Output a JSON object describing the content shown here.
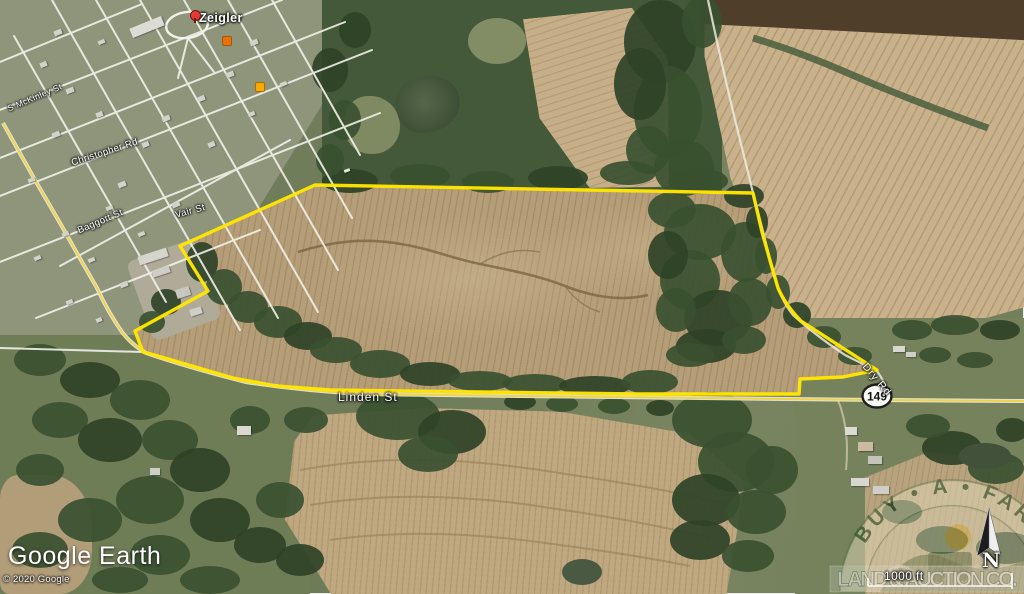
{
  "map": {
    "town_label": "Zeigler",
    "streets": {
      "mckinley": "S McKinley St",
      "christopher": "Christopher Rd",
      "baggott": "Baggott St",
      "vair": "Vair St",
      "linden": "Linden St",
      "dry": "Dry Rd"
    },
    "route_shield": "149",
    "boundary_color": "#ffe600",
    "route_color": "#ecd44e",
    "icons": {
      "place_pin": "red-balloon-pin",
      "poi_1": "orange-poi-square",
      "poi_2": "yellow-poi-square",
      "north_arrow": "compass-needle"
    }
  },
  "branding": {
    "google_earth": "Google Earth",
    "copyright": "© 2020 Google"
  },
  "watermark": {
    "arc_text": "BUY • A • FARM",
    "band_text": "LAND & AUCTION CO."
  },
  "scale_bar": {
    "label": "1000 ft"
  },
  "compass": {
    "north": "N"
  }
}
